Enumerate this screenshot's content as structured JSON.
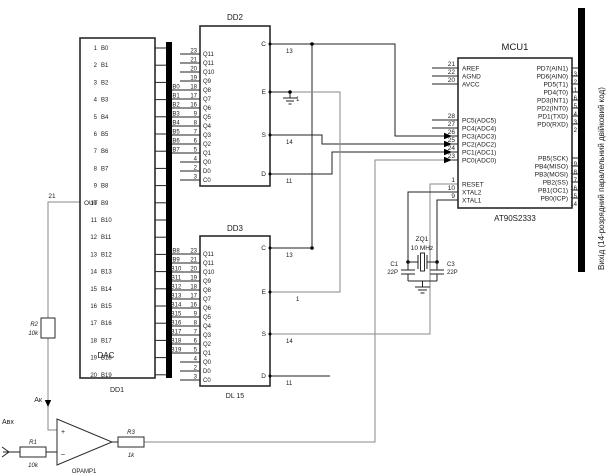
{
  "bus_note": "Вихід (14-розрядний паралельний двійковий код)",
  "dd1": {
    "ref": "DD1",
    "func": "DAC",
    "out": {
      "label": "OUT",
      "pin": "21"
    },
    "pins": [
      {
        "n": "1",
        "label": "B0"
      },
      {
        "n": "2",
        "label": "B1"
      },
      {
        "n": "3",
        "label": "B2"
      },
      {
        "n": "4",
        "label": "B3"
      },
      {
        "n": "5",
        "label": "B4"
      },
      {
        "n": "6",
        "label": "B5"
      },
      {
        "n": "7",
        "label": "B6"
      },
      {
        "n": "8",
        "label": "B7"
      },
      {
        "n": "9",
        "label": "B8"
      },
      {
        "n": "10",
        "label": "B9"
      },
      {
        "n": "11",
        "label": "B10"
      },
      {
        "n": "12",
        "label": "B11"
      },
      {
        "n": "13",
        "label": "B12"
      },
      {
        "n": "14",
        "label": "B13"
      },
      {
        "n": "15",
        "label": "B14"
      },
      {
        "n": "16",
        "label": "B15"
      },
      {
        "n": "17",
        "label": "B16"
      },
      {
        "n": "18",
        "label": "B17"
      },
      {
        "n": "19",
        "label": "B18"
      },
      {
        "n": "20",
        "label": "B19"
      }
    ]
  },
  "dd2": {
    "title": "DD2",
    "left_pins": [
      {
        "n": "23",
        "label": "Q11"
      },
      {
        "n": "21",
        "label": "Q11"
      },
      {
        "n": "20",
        "label": "Q10"
      },
      {
        "n": "19",
        "label": "Q9"
      },
      {
        "n": "18",
        "label": "Q8"
      },
      {
        "n": "17",
        "label": "Q7"
      },
      {
        "n": "16",
        "label": "Q6"
      },
      {
        "n": "9",
        "label": "Q5"
      },
      {
        "n": "8",
        "label": "Q4"
      },
      {
        "n": "7",
        "label": "Q3"
      },
      {
        "n": "6",
        "label": "Q2"
      },
      {
        "n": "5",
        "label": "Q1"
      },
      {
        "n": "4",
        "label": "Q0"
      },
      {
        "n": "2",
        "label": "D0"
      },
      {
        "n": "3",
        "label": "C0"
      }
    ],
    "bus_taps": [
      "B0",
      "B1",
      "B2",
      "B3",
      "B4",
      "B5",
      "B6",
      "B7"
    ],
    "right_pins": [
      {
        "label": "C",
        "n": "13"
      },
      {
        "label": "E",
        "n": "1"
      },
      {
        "label": "S",
        "n": "14"
      },
      {
        "label": "D",
        "n": "11"
      }
    ]
  },
  "dd3": {
    "title": "DD3",
    "part": "DL 15",
    "left_pins": [
      {
        "n": "23",
        "label": "Q11"
      },
      {
        "n": "21",
        "label": "Q11"
      },
      {
        "n": "20",
        "label": "Q10"
      },
      {
        "n": "19",
        "label": "Q9"
      },
      {
        "n": "18",
        "label": "Q8"
      },
      {
        "n": "17",
        "label": "Q7"
      },
      {
        "n": "16",
        "label": "Q6"
      },
      {
        "n": "9",
        "label": "Q5"
      },
      {
        "n": "8",
        "label": "Q4"
      },
      {
        "n": "7",
        "label": "Q3"
      },
      {
        "n": "6",
        "label": "Q2"
      },
      {
        "n": "5",
        "label": "Q1"
      },
      {
        "n": "4",
        "label": "Q0"
      },
      {
        "n": "2",
        "label": "D0"
      },
      {
        "n": "3",
        "label": "C0"
      }
    ],
    "bus_taps": [
      "B8",
      "B9",
      "B10",
      "B11",
      "B12",
      "B13",
      "B14",
      "B15",
      "B16",
      "B17",
      "B18",
      "B19"
    ],
    "right_pins": [
      {
        "label": "C",
        "n": "13"
      },
      {
        "label": "E",
        "n": "1"
      },
      {
        "label": "S",
        "n": "14"
      },
      {
        "label": "D",
        "n": "11"
      }
    ]
  },
  "mcu": {
    "title": "MCU1",
    "part": "AT90S2333",
    "left_pins": [
      {
        "n": "21",
        "label": "AREF"
      },
      {
        "n": "22",
        "label": "AGND"
      },
      {
        "n": "20",
        "label": "AVCC"
      },
      {
        "n": "28",
        "label": "PC5(ADC5)"
      },
      {
        "n": "27",
        "label": "PC4(ADC4)"
      },
      {
        "n": "26",
        "label": "PC3(ADC3)"
      },
      {
        "n": "25",
        "label": "PC2(ADC2)"
      },
      {
        "n": "24",
        "label": "PC1(ADC1)"
      },
      {
        "n": "23",
        "label": "PC0(ADC0)"
      },
      {
        "n": "1",
        "label": "RESET"
      },
      {
        "n": "10",
        "label": "XTAL2"
      },
      {
        "n": "9",
        "label": "XTAL1"
      }
    ],
    "right_pins": [
      {
        "label": "PD7(AIN1)",
        "n": "13"
      },
      {
        "label": "PD6(AIN0)",
        "n": "12"
      },
      {
        "label": "PD5(T1)",
        "n": "11"
      },
      {
        "label": "PD4(T0)",
        "n": "6"
      },
      {
        "label": "PD3(INT1)",
        "n": "5"
      },
      {
        "label": "PD2(INT0)",
        "n": "4"
      },
      {
        "label": "PD1(TXD)",
        "n": "3"
      },
      {
        "label": "PD0(RXD)",
        "n": "2"
      },
      {
        "label": "PB5(SCK)",
        "n": "19"
      },
      {
        "label": "PB4(MISO)",
        "n": "18"
      },
      {
        "label": "PB3(MOSI)",
        "n": "17"
      },
      {
        "label": "PB2(SS)",
        "n": "16"
      },
      {
        "label": "PB1(OC1)",
        "n": "15"
      },
      {
        "label": "PB0(ICP)",
        "n": "14"
      }
    ]
  },
  "xtal": {
    "ref": "ZQ1",
    "freq": "10 MHz"
  },
  "caps": [
    {
      "ref": "C1",
      "value": "22P"
    },
    {
      "ref": "C3",
      "value": "22P"
    }
  ],
  "analog": {
    "vin": "Авх",
    "vfb": "Ак",
    "opamp": "OPAMP1",
    "plus": "+",
    "minus": "–",
    "r1": {
      "ref": "R1",
      "value": "10k"
    },
    "r2": {
      "ref": "R2",
      "value": "10k"
    },
    "r3": {
      "ref": "R3",
      "value": "1k"
    }
  }
}
